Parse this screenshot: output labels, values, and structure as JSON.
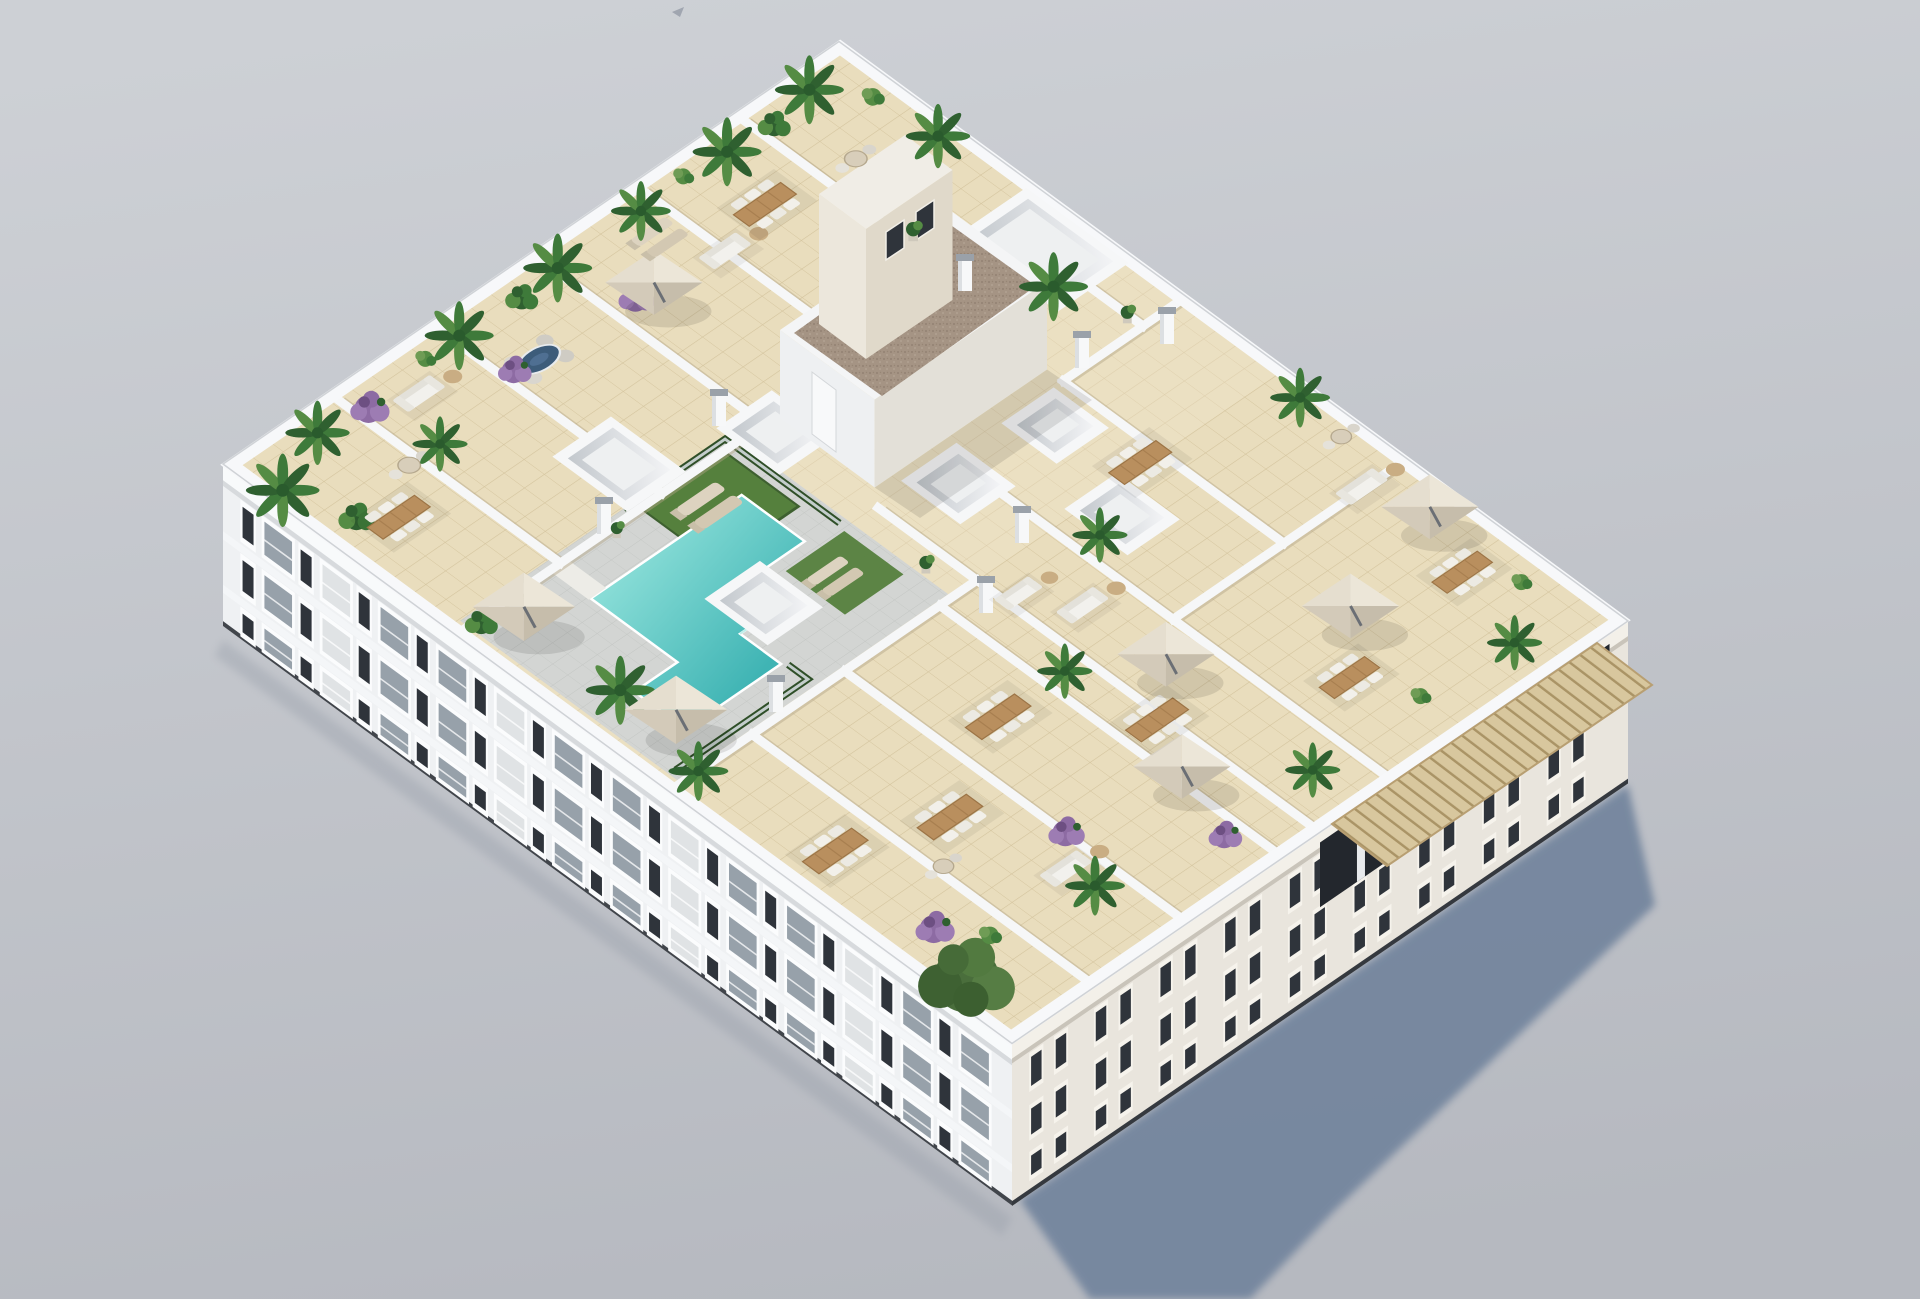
{
  "image": {
    "type": "3d-architectural-render",
    "subject": "Aerial isometric render of a white apartment block rooftop solarium with communal pool, artificial grass, private terraces, parasols, outdoor furniture and potted plants",
    "view": "high aerial from above, building rotated diagonally, sun from upper-left casting blue-grey shadow to lower-right",
    "width": 1920,
    "height": 1299
  },
  "theme": {
    "bg-top": "#cdd0d5",
    "bg-bottom": "#b6b9c0",
    "shadow": "#71839c",
    "white": "#f3f4f6",
    "white-bright": "#fafbfc",
    "facade-sw": "#eff1f3",
    "facade-se": "#e9e5dd",
    "window": "#2f343b",
    "glass": "#97a1aa",
    "tile": "#e9ddbd",
    "tile-line": "#d3c39c",
    "deck": "#d3d5d3",
    "pool-light": "#90e1da",
    "pool-dark": "#3fb4b4",
    "grass": "#55803d",
    "hedge": "#2f4f28",
    "green1": "#3e7a3a",
    "green2": "#2f6030",
    "green3": "#558c44",
    "purple1": "#8d6ba3",
    "purple2": "#9d7cb3",
    "wood": "#b98f5e",
    "canopy-light": "#e5decf",
    "canopy-dark": "#c6bdab",
    "gravel": "#a59484",
    "cream": "#e9e2d5",
    "cap": "#9aa1a9",
    "awning": "#d8c79e",
    "awning-line": "#aa9466"
  },
  "scene": {
    "background": "plain light grey studio backdrop",
    "shadow_direction": "lower-right",
    "building": {
      "storeys_visible": 3,
      "roof_use": "communal solarium with private terraces",
      "facade_colors": [
        "white",
        "warm white"
      ]
    },
    "rooftop": {
      "features": [
        "T-shaped turquoise swimming pool with grey deck bridge",
        "glass pool fence with green hedges",
        "artificial grass sunbathing area with loungers",
        "L-shaped stair core with brown gravel flat roof and door",
        "cream stair bulkhead with two small dark windows",
        "seven white skylight wells",
        "white parapet walls dividing private terraces",
        "beige cantilever parasols",
        "wooden dining tables with white chairs",
        "white lounge sofas",
        "potted palms, green shrubs and purple bougainvillea",
        "white chimney stacks with grey caps",
        "tan slatted pergola awning along right facade edge",
        "large olive tree at front corner"
      ],
      "counts": {
        "pools": 1,
        "parasols": 7,
        "dining_sets": 10,
        "sofas": 6,
        "lounger_pairs": 2,
        "skylights": 7,
        "chimneys": 8,
        "plants": 34
      }
    },
    "facades": {
      "sw": {
        "modules": 13,
        "rows": [
          {
            "t": 0.14,
            "h": 0.26
          },
          {
            "t": 0.47,
            "h": 0.26
          },
          {
            "t": 0.8,
            "h": 0.185
          }
        ]
      },
      "se": {
        "modules": 9,
        "rows": [
          {
            "t": 0.13,
            "h": 0.24
          },
          {
            "t": 0.45,
            "h": 0.22
          },
          {
            "t": 0.74,
            "h": 0.18
          }
        ]
      }
    },
    "items": [
      {
        "kind": "palm",
        "a": 0.02,
        "b": 0.06,
        "s": 1.6
      },
      {
        "kind": "ficus",
        "a": 0.05,
        "b": 0.13,
        "s": 1.2
      },
      {
        "kind": "palm",
        "a": 0.115,
        "b": 0.03,
        "s": 1.4
      },
      {
        "kind": "purple",
        "a": 0.185,
        "b": 0.04,
        "s": 1.4
      },
      {
        "kind": "dining6",
        "a": 0.085,
        "b": 0.155,
        "s": 1.25
      },
      {
        "kind": "roundtable",
        "a": 0.155,
        "b": 0.115,
        "s": 1.1
      },
      {
        "kind": "palm",
        "a": 0.205,
        "b": 0.115,
        "s": 1.2
      },
      {
        "kind": "sofa",
        "a": 0.245,
        "b": 0.06,
        "s": 1.2
      },
      {
        "kind": "bush",
        "a": 0.29,
        "b": 0.03,
        "s": 1.0
      },
      {
        "kind": "palm",
        "a": 0.345,
        "b": 0.03,
        "s": 1.5
      },
      {
        "kind": "dining-navy",
        "a": 0.385,
        "b": 0.1,
        "s": 1.3
      },
      {
        "kind": "purple",
        "a": 0.35,
        "b": 0.095,
        "s": 1.2
      },
      {
        "kind": "ficus",
        "a": 0.44,
        "b": 0.035,
        "s": 1.1
      },
      {
        "kind": "palm",
        "a": 0.505,
        "b": 0.03,
        "s": 1.5
      },
      {
        "kind": "purple",
        "a": 0.535,
        "b": 0.105,
        "s": 1.3
      },
      {
        "kind": "umbrella",
        "a": 0.565,
        "b": 0.105,
        "s": 1.8
      },
      {
        "kind": "loungers",
        "a": 0.625,
        "b": 0.065,
        "s": 1.2
      },
      {
        "kind": "palm",
        "a": 0.64,
        "b": 0.03,
        "s": 1.3
      },
      {
        "kind": "sofa",
        "a": 0.665,
        "b": 0.12,
        "s": 1.2
      },
      {
        "kind": "bush",
        "a": 0.715,
        "b": 0.025,
        "s": 1.0
      },
      {
        "kind": "dining6",
        "a": 0.75,
        "b": 0.1,
        "s": 1.25
      },
      {
        "kind": "palm",
        "a": 0.78,
        "b": 0.03,
        "s": 1.5
      },
      {
        "kind": "ficus",
        "a": 0.85,
        "b": 0.035,
        "s": 1.1
      },
      {
        "kind": "roundtable",
        "a": 0.88,
        "b": 0.115,
        "s": 1.1
      },
      {
        "kind": "palm",
        "a": 0.92,
        "b": 0.025,
        "s": 1.5
      },
      {
        "kind": "bush",
        "a": 0.965,
        "b": 0.07,
        "s": 1.1
      },
      {
        "kind": "palm",
        "a": 0.975,
        "b": 0.145,
        "s": 1.4
      },
      {
        "kind": "potplant",
        "a": 0.845,
        "b": 0.215,
        "s": 1.2
      },
      {
        "kind": "palm",
        "a": 0.9,
        "b": 0.35,
        "s": 1.5
      },
      {
        "kind": "potplant",
        "a": 0.93,
        "b": 0.42,
        "s": 1.1
      },
      {
        "kind": "ficus",
        "a": 0.035,
        "b": 0.3,
        "s": 1.1
      },
      {
        "kind": "umbrella",
        "a": 0.085,
        "b": 0.315,
        "s": 1.9
      },
      {
        "kind": "potplant",
        "a": 0.255,
        "b": 0.3,
        "s": 1.0
      },
      {
        "kind": "loungers",
        "a": 0.36,
        "b": 0.335,
        "s": 1.4
      },
      {
        "kind": "loungers",
        "a": 0.385,
        "b": 0.475,
        "s": 1.2
      },
      {
        "kind": "palm",
        "a": 0.075,
        "b": 0.445,
        "s": 1.5
      },
      {
        "kind": "umbrella",
        "a": 0.095,
        "b": 0.5,
        "s": 1.9
      },
      {
        "kind": "palm",
        "a": 0.048,
        "b": 0.565,
        "s": 1.3
      },
      {
        "kind": "potplant",
        "a": 0.475,
        "b": 0.52,
        "s": 1.1
      },
      {
        "kind": "sofa",
        "a": 0.52,
        "b": 0.605,
        "s": 1.1
      },
      {
        "kind": "dining6",
        "a": 0.07,
        "b": 0.72,
        "s": 1.3
      },
      {
        "kind": "roundtable",
        "a": 0.145,
        "b": 0.8,
        "s": 1.0
      },
      {
        "kind": "tree",
        "a": 0.035,
        "b": 0.915,
        "s": 2.2
      },
      {
        "kind": "purple",
        "a": 0.065,
        "b": 0.85,
        "s": 1.4
      },
      {
        "kind": "bush",
        "a": 0.105,
        "b": 0.89,
        "s": 1.1
      },
      {
        "kind": "dining6",
        "a": 0.205,
        "b": 0.76,
        "s": 1.3
      },
      {
        "kind": "sofa",
        "a": 0.245,
        "b": 0.88,
        "s": 1.2
      },
      {
        "kind": "purple",
        "a": 0.285,
        "b": 0.845,
        "s": 1.3
      },
      {
        "kind": "palm",
        "a": 0.25,
        "b": 0.91,
        "s": 1.3
      },
      {
        "kind": "dining6",
        "a": 0.36,
        "b": 0.7,
        "s": 1.3
      },
      {
        "kind": "umbrella",
        "a": 0.455,
        "b": 0.86,
        "s": 1.8
      },
      {
        "kind": "purple",
        "a": 0.415,
        "b": 0.945,
        "s": 1.2
      },
      {
        "kind": "palm",
        "a": 0.47,
        "b": 0.7,
        "s": 1.2
      },
      {
        "kind": "dining6",
        "a": 0.49,
        "b": 0.8,
        "s": 1.25
      },
      {
        "kind": "umbrella",
        "a": 0.57,
        "b": 0.75,
        "s": 1.8
      },
      {
        "kind": "palm",
        "a": 0.565,
        "b": 0.94,
        "s": 1.2
      },
      {
        "kind": "sofa",
        "a": 0.56,
        "b": 0.655,
        "s": 1.2
      },
      {
        "kind": "palm",
        "a": 0.655,
        "b": 0.6,
        "s": 1.2
      },
      {
        "kind": "dining6",
        "a": 0.77,
        "b": 0.56,
        "s": 1.25
      },
      {
        "kind": "umbrella",
        "a": 0.78,
        "b": 0.82,
        "s": 1.8
      },
      {
        "kind": "dining6",
        "a": 0.7,
        "b": 0.88,
        "s": 1.2
      },
      {
        "kind": "bush",
        "a": 0.74,
        "b": 0.94,
        "s": 1.0
      },
      {
        "kind": "roundtable",
        "a": 0.97,
        "b": 0.66,
        "s": 1.0
      },
      {
        "kind": "sofa",
        "a": 0.93,
        "b": 0.72,
        "s": 1.2
      },
      {
        "kind": "umbrella",
        "a": 0.96,
        "b": 0.78,
        "s": 1.8
      },
      {
        "kind": "dining6",
        "a": 0.915,
        "b": 0.855,
        "s": 1.2
      },
      {
        "kind": "palm",
        "a": 0.88,
        "b": 0.95,
        "s": 1.2
      },
      {
        "kind": "bush",
        "a": 0.955,
        "b": 0.9,
        "s": 1.0
      },
      {
        "kind": "palm",
        "a": 0.98,
        "b": 0.6,
        "s": 1.3
      }
    ],
    "chimneys": [
      [
        604,
        534
      ],
      [
        719,
        426
      ],
      [
        1022,
        543
      ],
      [
        965,
        291
      ],
      [
        1167,
        344
      ],
      [
        776,
        712
      ],
      [
        986,
        613
      ],
      [
        1082,
        368
      ]
    ]
  }
}
